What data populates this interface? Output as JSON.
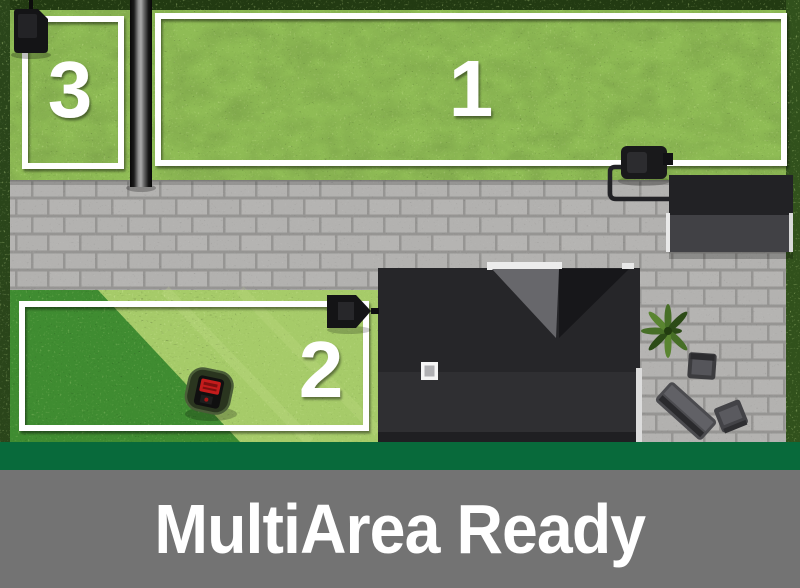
{
  "banner": {
    "title": "MultiArea Ready"
  },
  "zones": [
    {
      "label": "1"
    },
    {
      "label": "2"
    },
    {
      "label": "3"
    }
  ],
  "scene_objects": [
    "robotic-lawnmower",
    "charging-station-zone-1",
    "charging-station-zone-2",
    "charging-station-zone-3",
    "perimeter-wire-zone-1",
    "perimeter-wire-zone-2",
    "perimeter-wire-zone-3",
    "house-roof",
    "garage-roof",
    "chimney",
    "paved-path",
    "hedge",
    "garden-post",
    "potted-plant",
    "garden-furniture"
  ],
  "colors": {
    "brand_green": "#086a3b",
    "caption_gray": "#737373",
    "caption_text": "#ffffff",
    "lawn_light": "#8fbc55",
    "lawn_cut": "#a6cb69",
    "lawn_uncut": "#3f8c31",
    "hedge_green": "#2a451a",
    "pavement_gray": "#b3b2b0",
    "roof_dark": "#262629",
    "wire_white": "#ffffff"
  }
}
